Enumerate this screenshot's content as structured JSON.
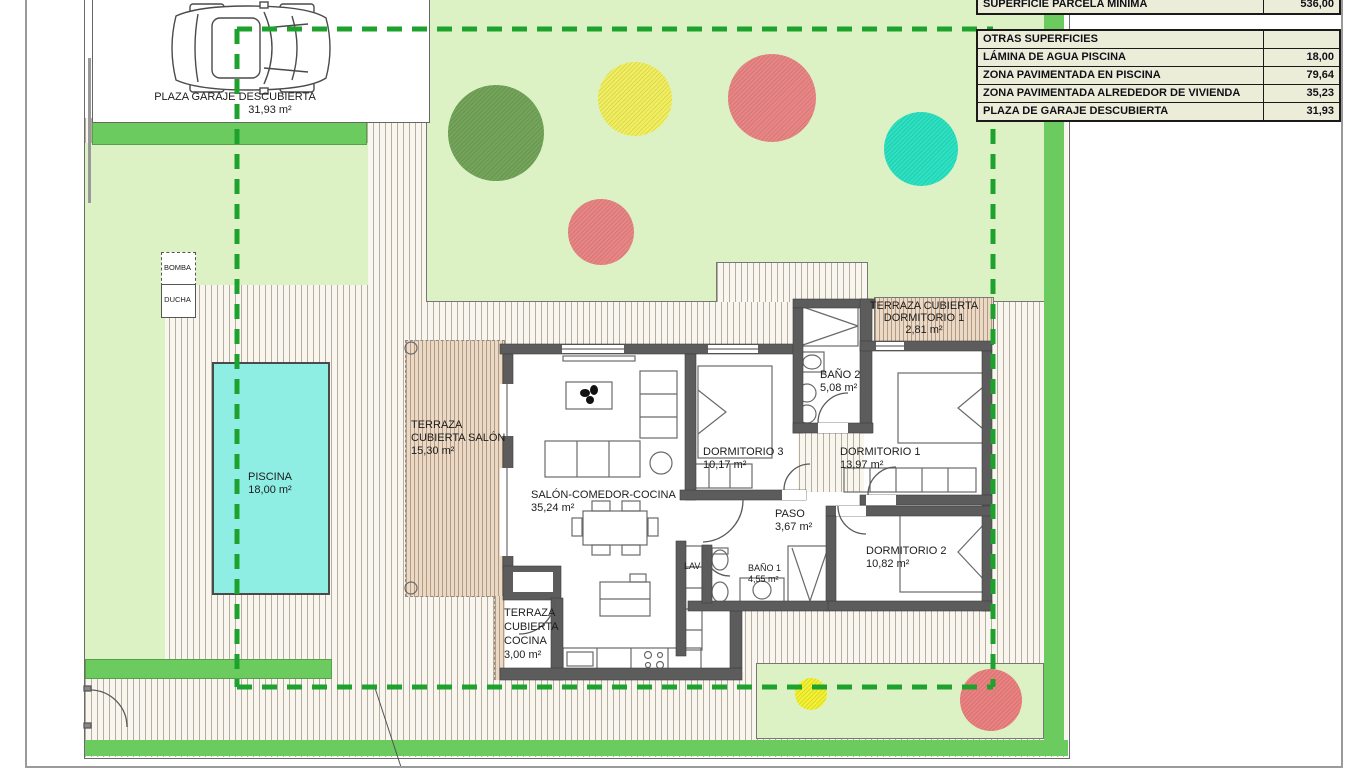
{
  "plan_title": "Villa site plan",
  "rooms": {
    "garage": {
      "name": "PLAZA GARAJE DESCUBIERTA",
      "area": "31,93 m²"
    },
    "bomba": {
      "name": "BOMBA"
    },
    "ducha": {
      "name": "DUCHA"
    },
    "piscina": {
      "name": "PISCINA",
      "area": "18,00 m²"
    },
    "terraza_salon": {
      "l1": "TERRAZA",
      "l2": "CUBIERTA SALÓN",
      "area": "15,30 m²"
    },
    "salon": {
      "name": "SALÓN-COMEDOR-COCINA",
      "area": "35,24 m²"
    },
    "terraza_cocina": {
      "l1": "TERRAZA",
      "l2": "CUBIERTA",
      "l3": "COCINA",
      "area": "3,00 m²"
    },
    "dormitorio3": {
      "name": "DORMITORIO 3",
      "area": "10,17 m²"
    },
    "bano2": {
      "name": "BAÑO 2",
      "area": "5,08 m²"
    },
    "terraza_dorm1": {
      "l1": "TERRAZA CUBIERTA",
      "l2": "DORMITORIO 1",
      "area": "2,81 m²"
    },
    "dormitorio1": {
      "name": "DORMITORIO 1",
      "area": "13,97 m²"
    },
    "paso": {
      "name": "PASO",
      "area": "3,67 m²"
    },
    "dormitorio2": {
      "name": "DORMITORIO 2",
      "area": "10,82 m²"
    },
    "bano1": {
      "name": "BAÑO 1",
      "area": "4,55 m²"
    },
    "lav": {
      "name": "LAV"
    }
  },
  "summary_table": {
    "top_row": {
      "label": "SUPERFICIE PARCELA MINIMA",
      "value": "536,00"
    },
    "header": {
      "label": "OTRAS SUPERFICIES",
      "value": ""
    },
    "rows": [
      {
        "label": "LÁMINA DE AGUA PISCINA",
        "value": "18,00"
      },
      {
        "label": "ZONA PAVIMENTADA EN PISCINA",
        "value": "79,64"
      },
      {
        "label": "ZONA PAVIMENTADA ALREDEDOR DE VIVIENDA",
        "value": "35,23"
      },
      {
        "label": "PLAZA DE GARAJE DESCUBIERTA",
        "value": "31,93"
      }
    ]
  },
  "colors": {
    "lawn": "#ddf2c4",
    "hedge": "#6ccb5f",
    "pool_water": "#8feee4",
    "setback_dashed_line": "#1da32d",
    "wall": "#5c5c5c",
    "paving_bg": "#f8f6ef",
    "terrace_bg": "#ead9c7",
    "tree_green": "#74a55a",
    "tree_yellow": "#f2ef5e",
    "tree_red": "#ea8585",
    "tree_cyan": "#2be2c2",
    "table_bg": "#ecedd9"
  }
}
